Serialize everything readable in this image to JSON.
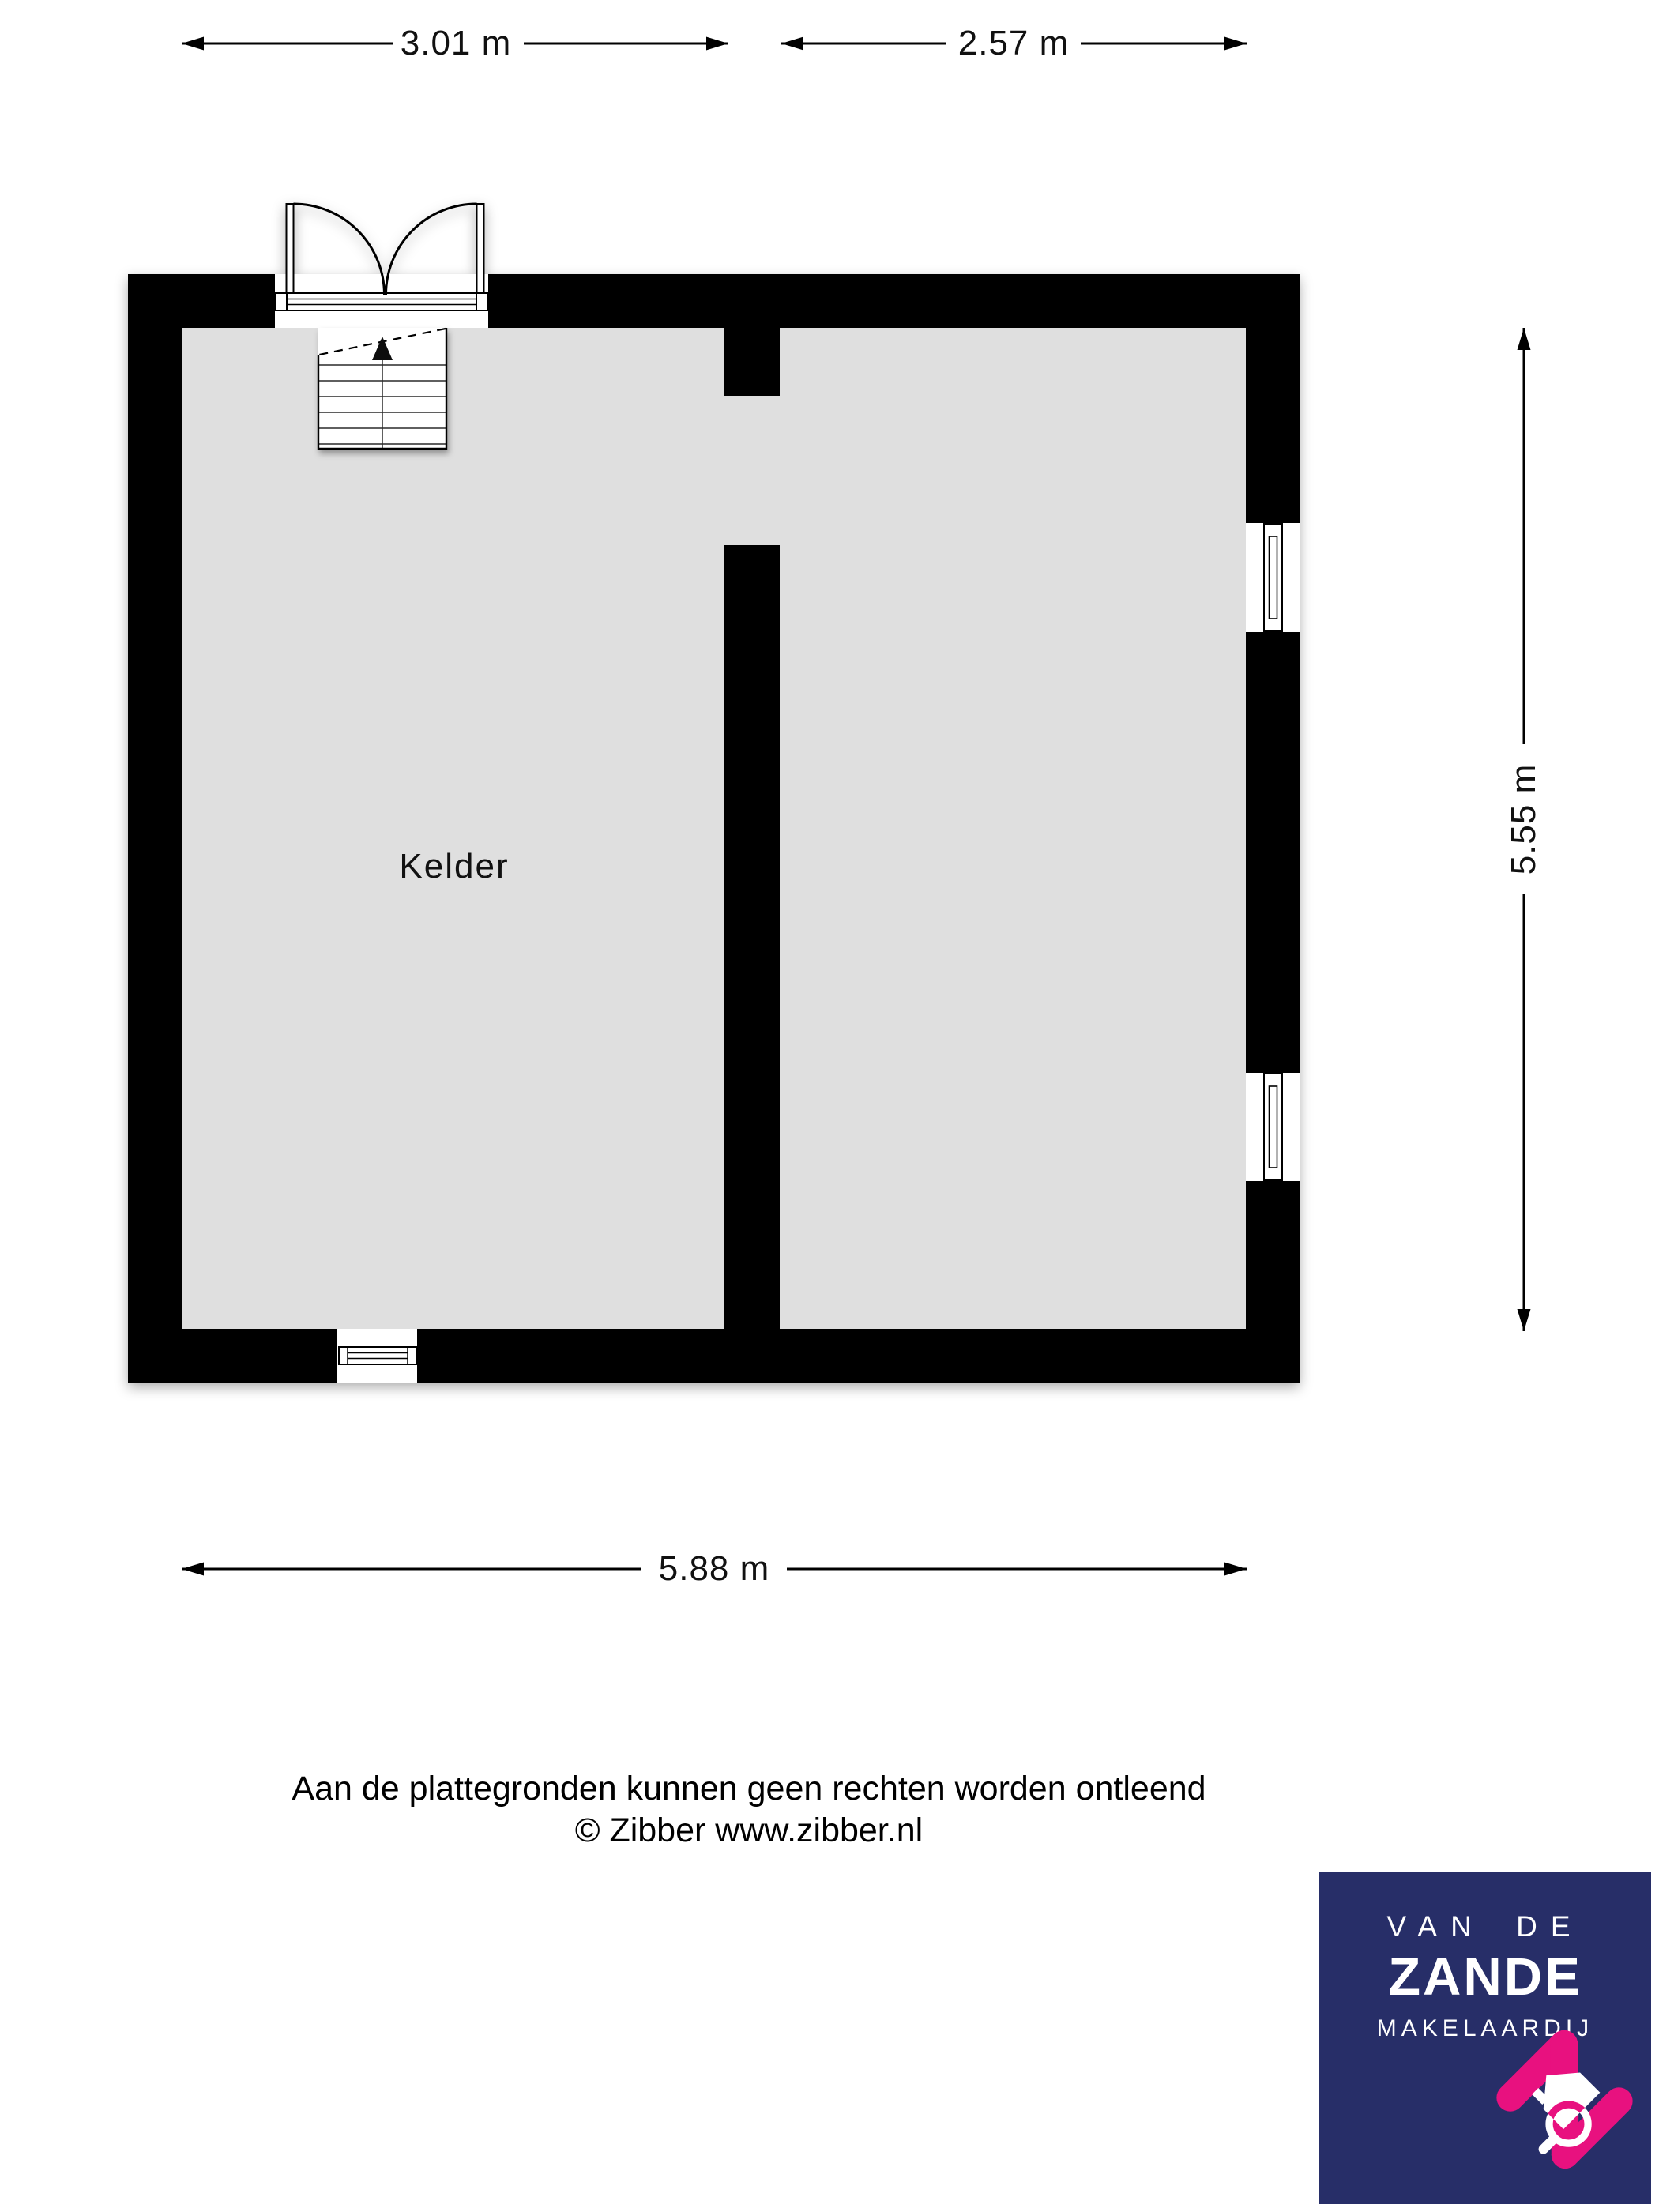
{
  "colors": {
    "page_bg": "#ffffff",
    "wall": "#000000",
    "floor": "#dfdfdf",
    "line": "#000000",
    "text": "#111111",
    "logo_navy": "#272e68",
    "logo_pink": "#e8117f",
    "logo_text": "#ffffff"
  },
  "plan": {
    "room_label": "Kelder",
    "dimensions": {
      "top_left": "3.01 m",
      "top_right": "2.57 m",
      "right": "5.55 m",
      "bottom": "5.88 m"
    },
    "symbols": {
      "double_door": "double-door-swing-icon",
      "stairs": "stairs-up-arrow-icon",
      "window_right_upper": "window-icon",
      "window_right_lower": "window-icon",
      "window_bottom": "window-icon"
    }
  },
  "disclaimer": {
    "line1": "Aan de plattegronden kunnen geen rechten worden ontleend",
    "line2": "© Zibber www.zibber.nl"
  },
  "logo": {
    "line1": "VAN DE",
    "line2": "ZANDE",
    "line3": "MAKELAARDIJ"
  }
}
